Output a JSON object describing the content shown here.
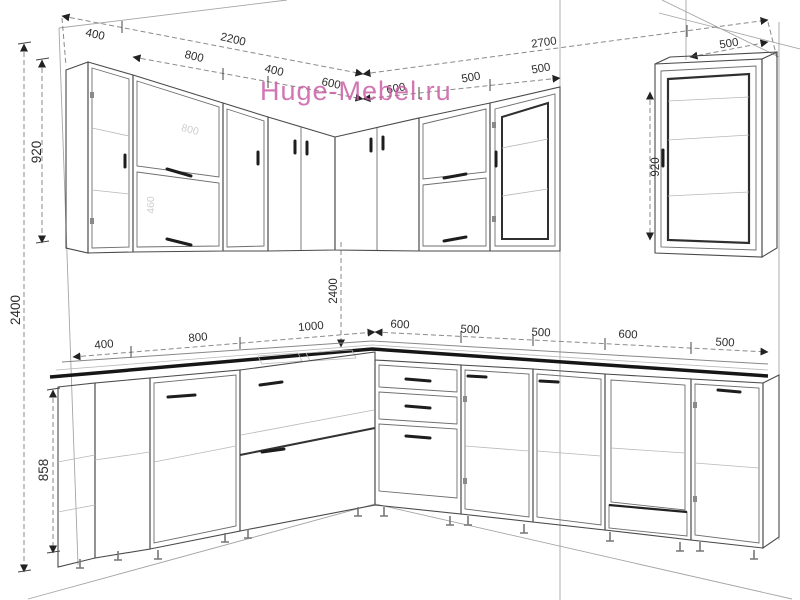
{
  "watermark": {
    "text": "Huge-Mebel.ru",
    "color": "#c95fa5"
  },
  "dims": {
    "top_left": [
      "400",
      "2200"
    ],
    "upper_left_run": [
      "800",
      "400",
      "600"
    ],
    "upper_right_run": [
      "600",
      "500",
      "500"
    ],
    "top_right": [
      "2700",
      "500"
    ],
    "upper_far_right": "500",
    "v920_left": "920",
    "v2400_left": "2400",
    "v858_left": "858",
    "v2400_mid": "2400",
    "v920_right": "920",
    "base_left_run": [
      "400",
      "800",
      "1000"
    ],
    "base_right_run": [
      "600",
      "500",
      "500",
      "600",
      "500"
    ]
  },
  "ghost_labels": [
    "800",
    "460"
  ]
}
